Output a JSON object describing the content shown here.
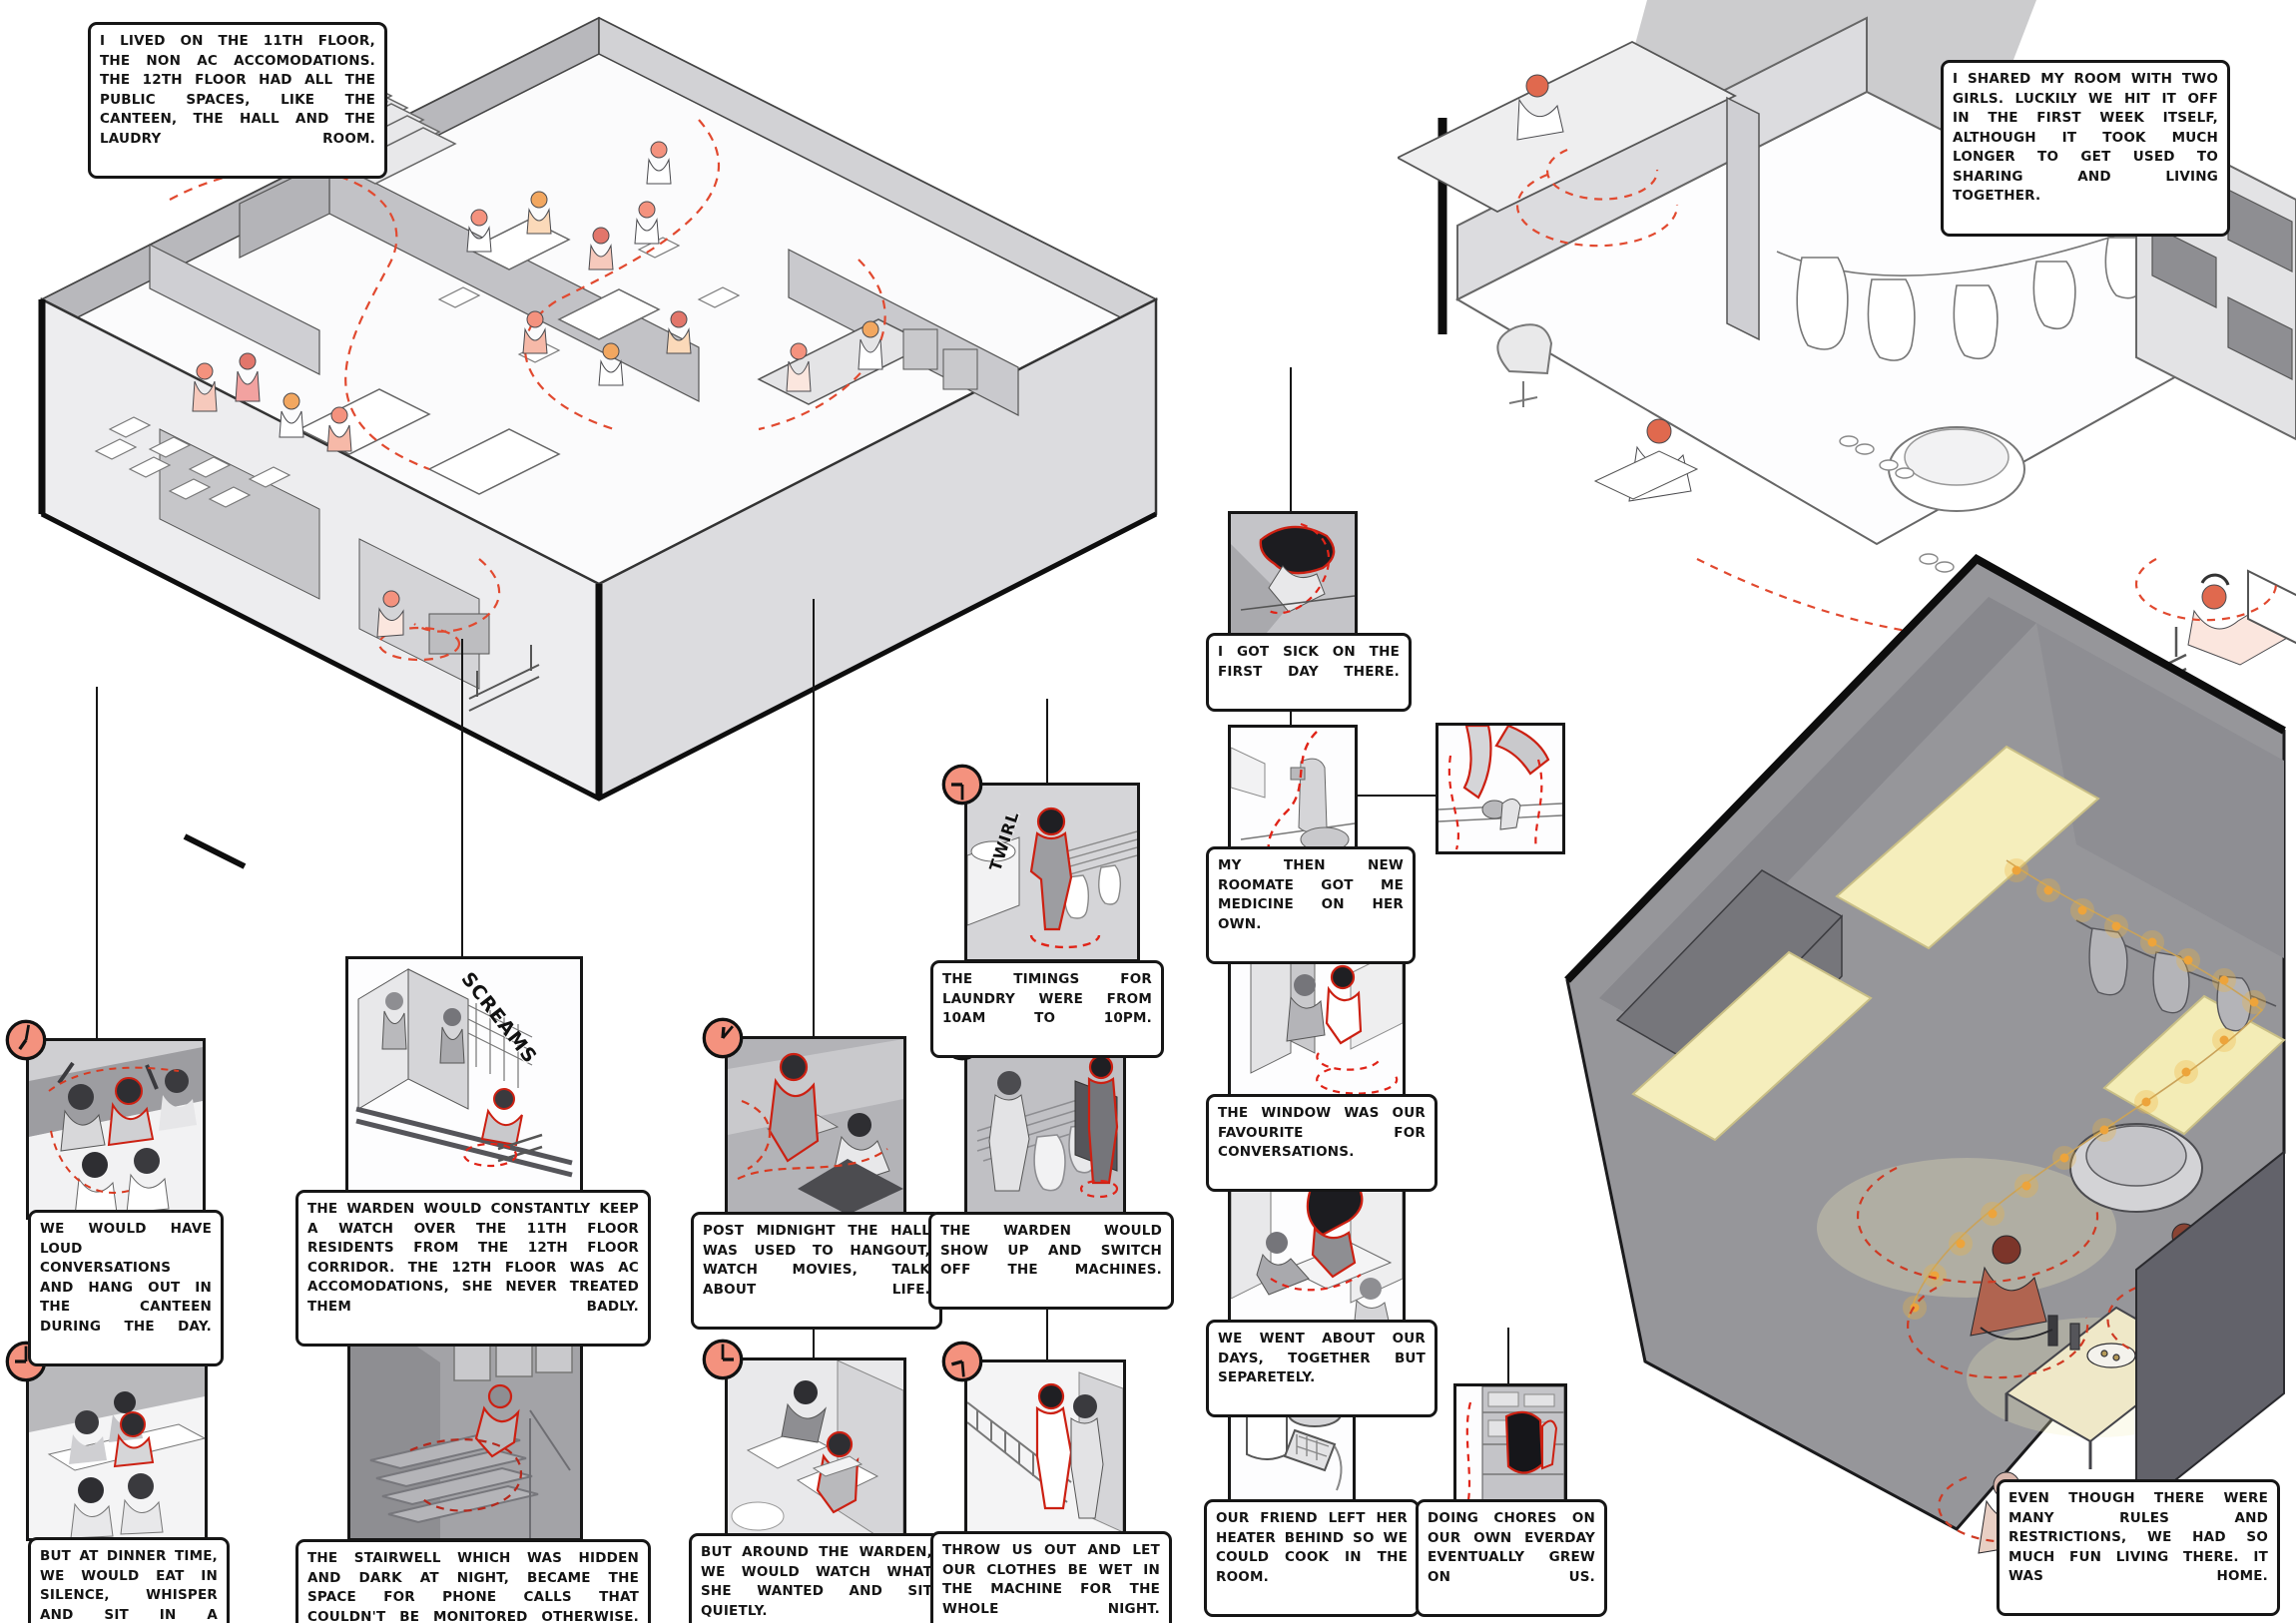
{
  "meta": {
    "title": "hostel life illustrated axonometric storyboard",
    "colors": {
      "accent_salmon": "#f4927e",
      "accent_orange": "#f2a760",
      "red_outline": "#cc2012",
      "red_dash": "#e1492f",
      "panel_gray": "#cbcbce",
      "night_gray": "#96969a",
      "warm_light_yellow": "#f5eebc",
      "fairy_light": "#eda43b",
      "ink": "#161616"
    }
  },
  "narration": {
    "intro_left": "I LIVED ON THE 11TH FLOOR, THE NON AC ACCOMODATIONS. THE 12TH FLOOR HAD ALL THE PUBLIC SPACES, LIKE THE CANTEEN, THE HALL AND THE LAUDRY ROOM.",
    "intro_right": "I SHARED MY ROOM WITH TWO GIRLS. LUCKILY WE HIT IT OFF IN THE FIRST WEEK ITSELF, ALTHOUGH IT TOOK MUCH LONGER TO GET USED TO SHARING AND LIVING TOGETHER.",
    "outro": "EVEN THOUGH THERE WERE MANY RULES AND RESTRICTIONS, WE HAD SO MUCH FUN LIVING THERE. IT WAS HOME."
  },
  "sfx": {
    "twirl": "TWIRL",
    "screams": "SCREAMS"
  },
  "panels": {
    "canteen_day": {
      "caption": "WE WOULD HAVE LOUD CONVERSATIONS AND HANG OUT IN THE CANTEEN DURING THE DAY.",
      "clock": {
        "hour_deg": 215,
        "minute_deg": 10
      }
    },
    "dinner": {
      "caption": "BUT AT DINNER TIME, WE WOULD EAT IN SILENCE, WHISPER AND SIT IN A 'DISCIPLINED' MANNER.",
      "clock": {
        "hour_deg": 270,
        "minute_deg": 0
      }
    },
    "warden_watch": {
      "caption": "THE WARDEN WOULD CONSTANTLY KEEP A WATCH OVER THE 11TH FLOOR RESIDENTS FROM THE 12TH FLOOR CORRIDOR. THE 12TH FLOOR WAS AC ACCOMODATIONS, SHE NEVER TREATED THEM BADLY."
    },
    "stairwell": {
      "caption": "THE STAIRWELL WHICH WAS HIDDEN AND DARK AT NIGHT, BECAME THE SPACE FOR PHONE CALLS THAT COULDN'T BE MONITORED OTHERWISE.",
      "clock": {
        "hour_deg": 45,
        "minute_deg": 140
      }
    },
    "post_midnight": {
      "caption": "POST MIDNIGHT THE HALL WAS USED TO HANGOUT, WATCH MOVIES, TALK ABOUT LIFE.",
      "clock": {
        "hour_deg": 5,
        "minute_deg": 40
      }
    },
    "around_warden": {
      "caption": "BUT AROUND THE WARDEN, WE WOULD WATCH WHAT SHE WANTED AND SIT QUIETLY.",
      "clock": {
        "hour_deg": 90,
        "minute_deg": 0
      }
    },
    "laundry": {
      "caption": "THE TIMINGS FOR LAUNDRY WERE FROM 10AM TO 10PM.",
      "clock": {
        "hour_deg": 270,
        "minute_deg": 180
      }
    },
    "warden_switch": {
      "caption": "THE WARDEN WOULD SHOW UP AND SWITCH OFF THE MACHINES.",
      "clock": {
        "hour_deg": 285,
        "minute_deg": 115
      }
    },
    "throw_out": {
      "caption": "THROW US OUT AND LET OUR CLOTHES BE WET IN THE MACHINE FOR THE WHOLE NIGHT.",
      "clock": {
        "hour_deg": 255,
        "minute_deg": 175
      }
    },
    "sick": {
      "caption": "I GOT SICK ON THE FIRST DAY THERE."
    },
    "medicine": {
      "caption": "MY THEN NEW ROOMATE GOT ME MEDICINE ON HER OWN."
    },
    "window": {
      "caption": "THE WINDOW WAS OUR FAVOURITE FOR CONVERSATIONS."
    },
    "days": {
      "caption": "WE WENT ABOUT OUR DAYS, TOGETHER BUT SEPARETELY."
    },
    "heater": {
      "caption": "OUR FRIEND LEFT HER HEATER BEHIND SO WE COULD COOK IN THE ROOM."
    },
    "chores": {
      "caption": "DOING CHORES ON OUR OWN EVERDAY EVENTUALLY GREW ON US."
    }
  }
}
